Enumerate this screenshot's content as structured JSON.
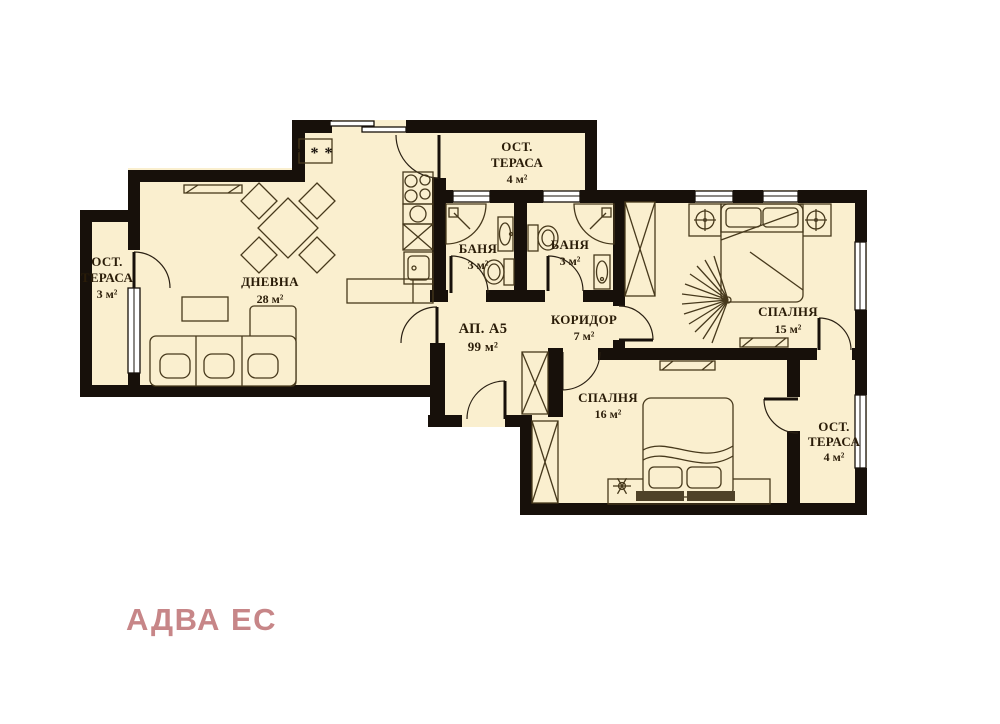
{
  "brand": {
    "name": "АДВА ЕС",
    "color": "#c78688"
  },
  "rooms": [
    {
      "id": "terrace-left",
      "name": "ОСТ. ТЕРАСА",
      "area": "3 м²",
      "lines": [
        "ОСТ.",
        "ТЕРАСА",
        "3 м²"
      ]
    },
    {
      "id": "living-room",
      "name": "ДНЕВНА",
      "area": "28 м²",
      "lines": [
        "ДНЕВНА",
        "28 м²"
      ]
    },
    {
      "id": "terrace-top",
      "name": "ОСТ. ТЕРАСА",
      "area": "4 м²",
      "lines": [
        "ОСТ.",
        "ТЕРАСА",
        "4 м²"
      ]
    },
    {
      "id": "bathroom-1",
      "name": "БАНЯ",
      "area": "3 м²",
      "lines": [
        "БАНЯ",
        "3 м²"
      ]
    },
    {
      "id": "bathroom-2",
      "name": "БАНЯ",
      "area": "3 м²",
      "lines": [
        "БАНЯ",
        "3 м²"
      ]
    },
    {
      "id": "apartment-hall",
      "name": "АП. А5",
      "area": "99 м²",
      "lines": [
        "АП. А5",
        "99 м²"
      ]
    },
    {
      "id": "corridor",
      "name": "КОРИДОР",
      "area": "7 м²",
      "lines": [
        "КОРИДОР",
        "7 м²"
      ]
    },
    {
      "id": "bedroom-15",
      "name": "СПАЛНЯ",
      "area": "15 м²",
      "lines": [
        "СПАЛНЯ",
        "15 м²"
      ]
    },
    {
      "id": "bedroom-16",
      "name": "СПАЛНЯ",
      "area": "16 м²",
      "lines": [
        "СПАЛНЯ",
        "16 м²"
      ]
    },
    {
      "id": "terrace-right",
      "name": "ОСТ. ТЕРАСА",
      "area": "4 м²",
      "lines": [
        "ОСТ.",
        "ТЕРАСА",
        "4 м²"
      ]
    }
  ],
  "symbols": {
    "kitchen_marker": "* * *"
  },
  "colors": {
    "background": "#ffffff",
    "floor": "#faefcf",
    "wall": "#17100a",
    "furniture_line": "#47391c",
    "label": "#2a1c08",
    "logo": "#c78688"
  }
}
